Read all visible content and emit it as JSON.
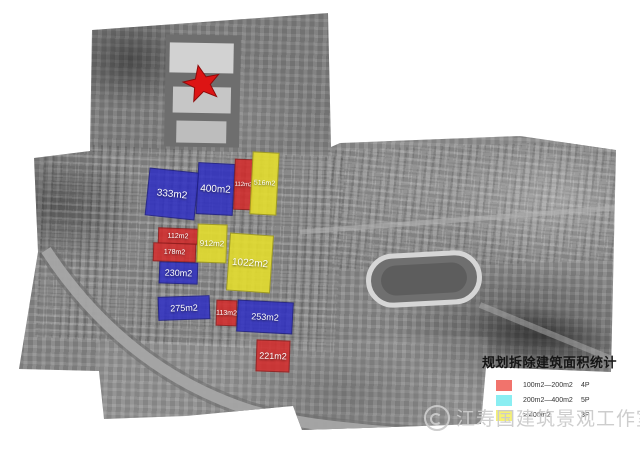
{
  "map": {
    "marker": {
      "name": "red-star",
      "color": "#dd1414"
    },
    "colors": {
      "red": "rgba(212,42,42,0.86)",
      "blue": "rgba(45,45,195,0.84)",
      "yellow": "rgba(227,221,45,0.9)"
    },
    "buildings": [
      {
        "label": "333m2",
        "cat": "blue",
        "x": 147,
        "y": 170,
        "w": 50,
        "h": 48,
        "r": 6,
        "fs": 10
      },
      {
        "label": "400m2",
        "cat": "blue",
        "x": 197,
        "y": 163,
        "w": 37,
        "h": 52,
        "r": 3,
        "fs": 10
      },
      {
        "label": "112m2",
        "cat": "red",
        "x": 234,
        "y": 159,
        "w": 19,
        "h": 51,
        "r": 2,
        "fs": 6
      },
      {
        "label": "516m2",
        "cat": "yellow",
        "x": 251,
        "y": 152,
        "w": 27,
        "h": 63,
        "r": 3,
        "fs": 7
      },
      {
        "label": "112m2",
        "cat": "red",
        "x": 158,
        "y": 228,
        "w": 40,
        "h": 16,
        "r": 2,
        "fs": 7
      },
      {
        "label": "178m2",
        "cat": "red",
        "x": 153,
        "y": 243,
        "w": 43,
        "h": 19,
        "r": 2,
        "fs": 7
      },
      {
        "label": "912m2",
        "cat": "yellow",
        "x": 197,
        "y": 224,
        "w": 30,
        "h": 39,
        "r": 2,
        "fs": 8
      },
      {
        "label": "1022m2",
        "cat": "yellow",
        "x": 228,
        "y": 234,
        "w": 44,
        "h": 58,
        "r": 4,
        "fs": 10
      },
      {
        "label": "230m2",
        "cat": "blue",
        "x": 159,
        "y": 262,
        "w": 39,
        "h": 22,
        "r": 2,
        "fs": 9
      },
      {
        "label": "275m2",
        "cat": "blue",
        "x": 158,
        "y": 296,
        "w": 52,
        "h": 24,
        "r": -2,
        "fs": 9
      },
      {
        "label": "113m2",
        "cat": "red",
        "x": 216,
        "y": 300,
        "w": 21,
        "h": 26,
        "r": 2,
        "fs": 7
      },
      {
        "label": "253m2",
        "cat": "blue",
        "x": 237,
        "y": 301,
        "w": 56,
        "h": 32,
        "r": 3,
        "fs": 9
      },
      {
        "label": "221m2",
        "cat": "red",
        "x": 256,
        "y": 340,
        "w": 34,
        "h": 32,
        "r": 2,
        "fs": 9
      }
    ]
  },
  "legend": {
    "title": "规划拆除建筑面积统计",
    "rows": [
      {
        "swatch": "#f1736c",
        "range": "100m2—200m2",
        "count": "4P"
      },
      {
        "swatch": "#8aeef2",
        "range": "200m2—400m2",
        "count": "5P"
      },
      {
        "swatch": "#f6f173",
        "range": "> 400m2",
        "count": "3P"
      }
    ]
  },
  "watermark": {
    "text": "江寿国建筑景观工作室"
  }
}
